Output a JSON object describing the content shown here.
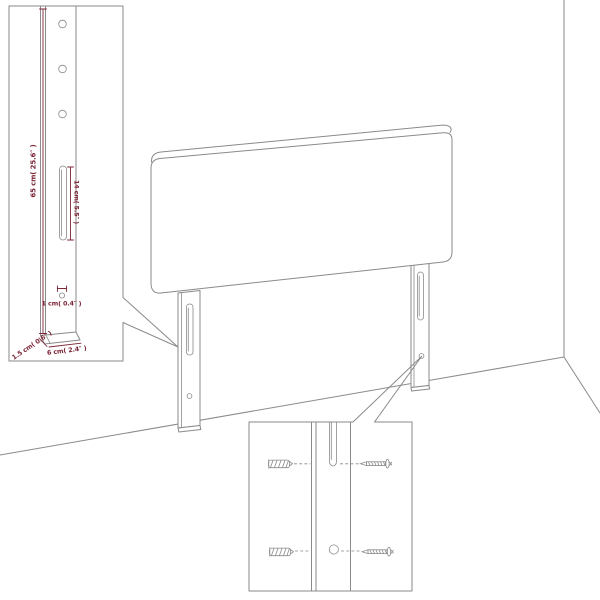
{
  "page": {
    "background": "#ffffff",
    "colors": {
      "line": "#8a8a8a",
      "dimension": "#7c2636"
    }
  },
  "labels": {
    "height": "65 cm( 25.6″ )",
    "slot_length": "14 cm( 5.5″ )",
    "hole_diameter": "1 cm( 0.4″ )",
    "leg_depth": "1.5 cm( 0.6″ )",
    "leg_width": "6 cm( 2.4″ )"
  }
}
